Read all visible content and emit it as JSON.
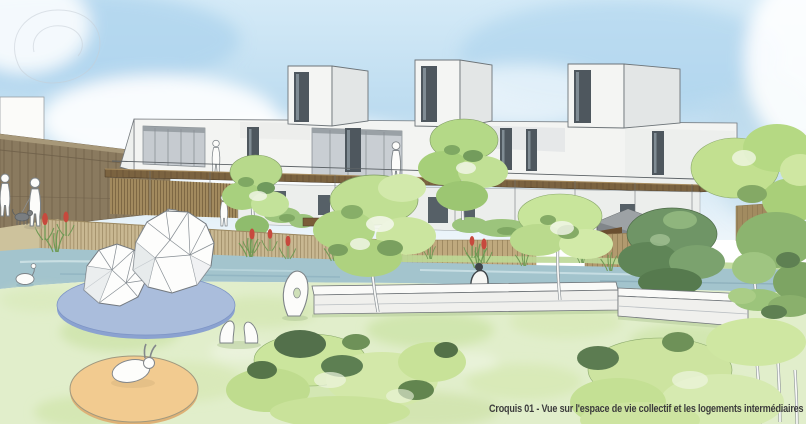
{
  "caption": {
    "text": "Croquis 01 - Vue sur l'espace de vie collectif et les logements intermédiaires",
    "figure_label": "Croquis 01",
    "figure_description": "Vue sur l'espace de vie collectif et les logements intermédiaires"
  },
  "palette": {
    "sky_blue": "#bddcf0",
    "cloud_white": "#ffffff",
    "building_white": "#f3f4f2",
    "building_shade": "#d9dcdd",
    "window_dark": "#4e575e",
    "wood_deck": "#7b6340",
    "under_deck_slats": "#a28a5e",
    "fence_wood": "#8a7a5f",
    "bamboo_fence": "#c9b892",
    "garden_fence": "#bfa97e",
    "water": "#a3c4cd",
    "lawn": "#e1eecb",
    "lawn_texture": "#cde4aa",
    "tree_light": "#c0df93",
    "tree_mid": "#8cb46f",
    "tree_dark": "#6f9566",
    "foliage_deep": "#53704b",
    "platform_blue": "#aabddc",
    "sand_orange": "#f2cb90",
    "flower_red": "#c7493d",
    "path_tan": "#cdc29c",
    "shed_gray": "#81868a",
    "sketch_outline": "#7d8387",
    "caption_gray": "#3c3c3c"
  }
}
